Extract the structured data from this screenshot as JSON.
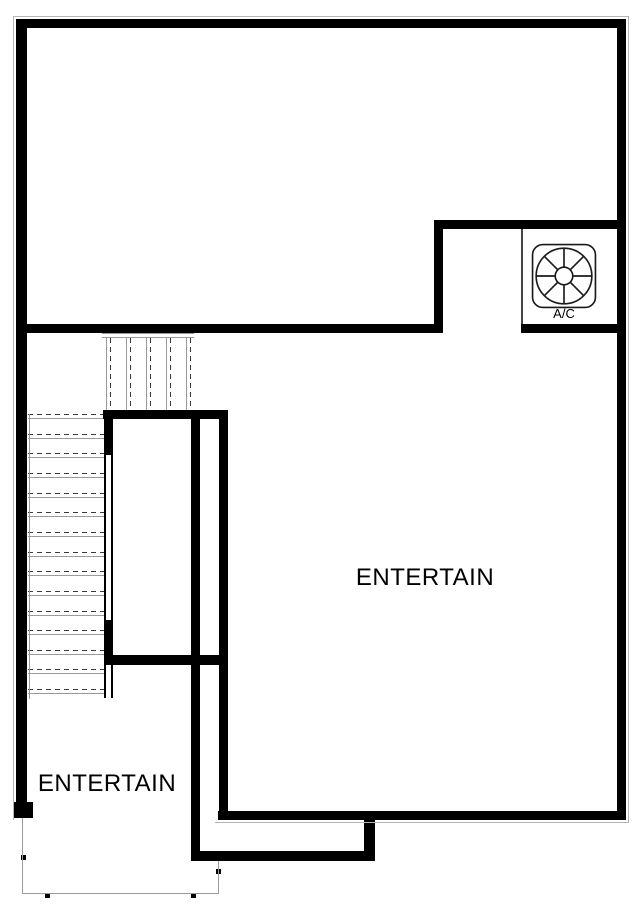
{
  "labels": {
    "room_main": "ENTERTAIN",
    "room_lower": "ENTERTAIN",
    "ac_unit": "A/C"
  },
  "colors": {
    "wall": "#000000",
    "line": "#9a9a9a",
    "dash": "#3a3a3a",
    "partition": "#444444",
    "hair": "#b5b5b5",
    "text": "#000000",
    "bg": "#ffffff"
  },
  "plan": {
    "walls": [
      {
        "name": "top-exterior-wall",
        "x": 16,
        "y": 19,
        "w": 610,
        "h": 9
      },
      {
        "name": "left-exterior-wall",
        "x": 16,
        "y": 19,
        "w": 11,
        "h": 799
      },
      {
        "name": "left-wall-end-stub",
        "x": 13,
        "y": 802,
        "w": 20,
        "h": 16
      },
      {
        "name": "right-exterior-wall",
        "x": 617,
        "y": 19,
        "w": 9,
        "h": 801
      },
      {
        "name": "bottom-right-exterior-wall",
        "x": 218,
        "y": 811,
        "w": 408,
        "h": 9
      },
      {
        "name": "ac-closet-top-wall",
        "x": 434,
        "y": 220,
        "w": 183,
        "h": 9
      },
      {
        "name": "notch-vertical-wall",
        "x": 434,
        "y": 220,
        "w": 9,
        "h": 113
      },
      {
        "name": "mid-horizontal-wall",
        "x": 16,
        "y": 324,
        "w": 427,
        "h": 9
      },
      {
        "name": "ac-closet-bottom-wall",
        "x": 521,
        "y": 324,
        "w": 96,
        "h": 9
      },
      {
        "name": "stair-top-wall",
        "x": 103,
        "y": 410,
        "w": 125,
        "h": 9
      },
      {
        "name": "stair-right-wall-upper",
        "x": 104,
        "y": 410,
        "w": 9,
        "h": 45
      },
      {
        "name": "stair-right-wall-lower",
        "x": 104,
        "y": 620,
        "w": 9,
        "h": 45
      },
      {
        "name": "mid-left-horizontal-wall",
        "x": 104,
        "y": 655,
        "w": 124,
        "h": 10
      },
      {
        "name": "inner-wall-left",
        "x": 191,
        "y": 410,
        "w": 9,
        "h": 451
      },
      {
        "name": "inner-wall-right",
        "x": 219,
        "y": 410,
        "w": 9,
        "h": 410
      },
      {
        "name": "bottom-left-wall",
        "x": 191,
        "y": 851,
        "w": 184,
        "h": 10
      },
      {
        "name": "bottom-jog-wall",
        "x": 364,
        "y": 820,
        "w": 11,
        "h": 41
      }
    ],
    "hairlines": [
      {
        "name": "outer-hairline-top",
        "x": 13,
        "y": 16,
        "w": 616,
        "h": 1
      },
      {
        "name": "outer-hairline-left",
        "x": 13,
        "y": 16,
        "w": 1,
        "h": 804
      },
      {
        "name": "outer-hairline-right",
        "x": 628,
        "y": 16,
        "w": 1,
        "h": 806
      },
      {
        "name": "outer-hairline-bottom",
        "x": 215,
        "y": 822,
        "w": 414,
        "h": 1
      }
    ],
    "thin_lines": [
      {
        "name": "porch-left-line",
        "x": 22,
        "y": 818,
        "w": 1,
        "h": 76
      },
      {
        "name": "porch-bottom-line",
        "x": 22,
        "y": 893,
        "w": 197,
        "h": 1
      },
      {
        "name": "porch-right-line",
        "x": 218,
        "y": 861,
        "w": 1,
        "h": 33
      },
      {
        "name": "stair-left-stringer",
        "x": 29,
        "y": 414,
        "w": 1,
        "h": 285
      },
      {
        "name": "stair-header-line-1",
        "x": 102,
        "y": 333,
        "w": 92,
        "h": 1
      },
      {
        "name": "stair-header-line-2",
        "x": 102,
        "y": 337,
        "w": 92,
        "h": 1
      }
    ],
    "partitions": [
      {
        "name": "ac-closet-partition-line",
        "x": 521,
        "y": 229,
        "w": 2,
        "h": 95
      }
    ],
    "open_edges": [
      {
        "name": "stair-open-edge-upper",
        "x": 104,
        "y": 453,
        "w": 9,
        "h": 170
      },
      {
        "name": "stair-open-edge-lower",
        "x": 104,
        "y": 665,
        "w": 9,
        "h": 33
      }
    ],
    "ticks": [
      {
        "x": 23,
        "y": 857
      },
      {
        "x": 47,
        "y": 895
      },
      {
        "x": 193,
        "y": 895
      },
      {
        "x": 218,
        "y": 871
      }
    ],
    "stairs": {
      "x_left": 28,
      "x_right": 104,
      "y_start": 418,
      "step": 19.65,
      "count": 15,
      "dash_offset": 4
    },
    "upper_flight": {
      "y_top": 338,
      "y_bottom": 410,
      "xs": [
        108,
        128,
        148,
        168,
        188
      ],
      "pair_gap": 4
    }
  }
}
